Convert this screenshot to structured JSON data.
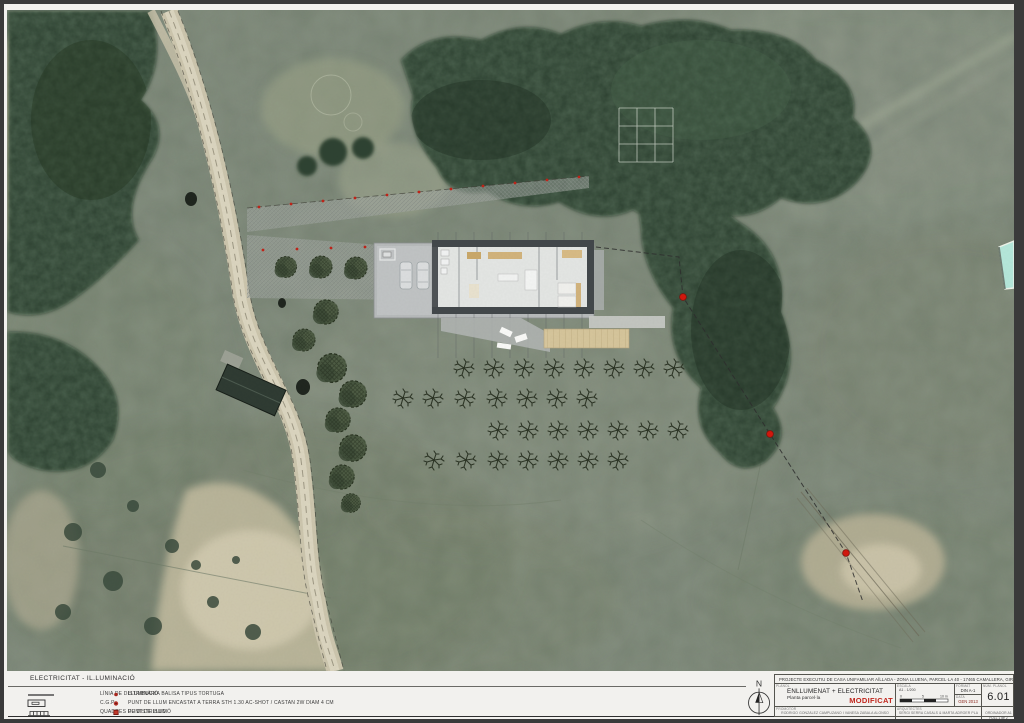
{
  "legend": {
    "title": "ELECTRICITAT - IL.LUMINACIÓ",
    "left_items": [
      {
        "symbol": "distribution-line",
        "label": "LÍNIA DE DISTRIBUCIÓ"
      },
      {
        "symbol": "cgp-box",
        "label": "C.G.P."
      },
      {
        "symbol": "distribution-board",
        "label": "QUADRES DE  DISTRIBUCIÓ"
      }
    ],
    "right_items": [
      {
        "symbol": "balisa-light",
        "label": "LLUMINÀRIA BALISA TIPUS TORTUGA"
      },
      {
        "symbol": "recessed-ground-light",
        "label": "PUNT DE LLUM ENCASTAT A TERRA STH 1.30 AC-SHOT / CASTAN 2W DIAM 4 CM"
      },
      {
        "symbol": "light-point",
        "label": "PUNT DE LLUM"
      }
    ]
  },
  "titleblock": {
    "north_label": "N",
    "project_title": "PROJECTE EXECUTIU DE CASA UNIFAMILIAR AÏLLADA - ZONA LLUENA, PARCEL·LA 40 - 17465 CAMALLERA, GIRONA",
    "plan_label": "PLÀNOL",
    "plan_title": "ENLLUMENAT + ELECTRICITAT",
    "plan_subtitle": "Planta parcel·la",
    "status": "MODIFICAT",
    "scale_label": "ESCALA",
    "scale_value": "A1 - 1/200",
    "scale_ticks": [
      "0",
      "5",
      "10 m"
    ],
    "format_label": "FORMAT",
    "format_value": "DIN A-1",
    "date_label": "DATA",
    "date_value": "GEN 2013",
    "sheet_label": "NÚM. PLÀNOL",
    "sheet_number": "6.01",
    "promoter_label": "PROMOTOR",
    "promoter_name": "RODRIGO GONZÁLEZ CAMPUZANO I VANESA ZABALA ALONSO",
    "architect_label": "ARQUITECTES",
    "architect_name": "SERGI SERRA CASALS & MARTA ADROER PLA",
    "cell_g_line1": "ORDINADOR A1",
    "cell_g_line2": "FULL 1 de 2"
  },
  "colors": {
    "status_red": "#c0261c",
    "light_point_red": "#d3160c",
    "field_green": "#7e897a",
    "forest_green": "#2d4331",
    "sand": "#cdc6ae",
    "deck_beige": "#dbc99d",
    "pool_cyan": "#b5e7da",
    "platform_gray": "#b7babb"
  }
}
